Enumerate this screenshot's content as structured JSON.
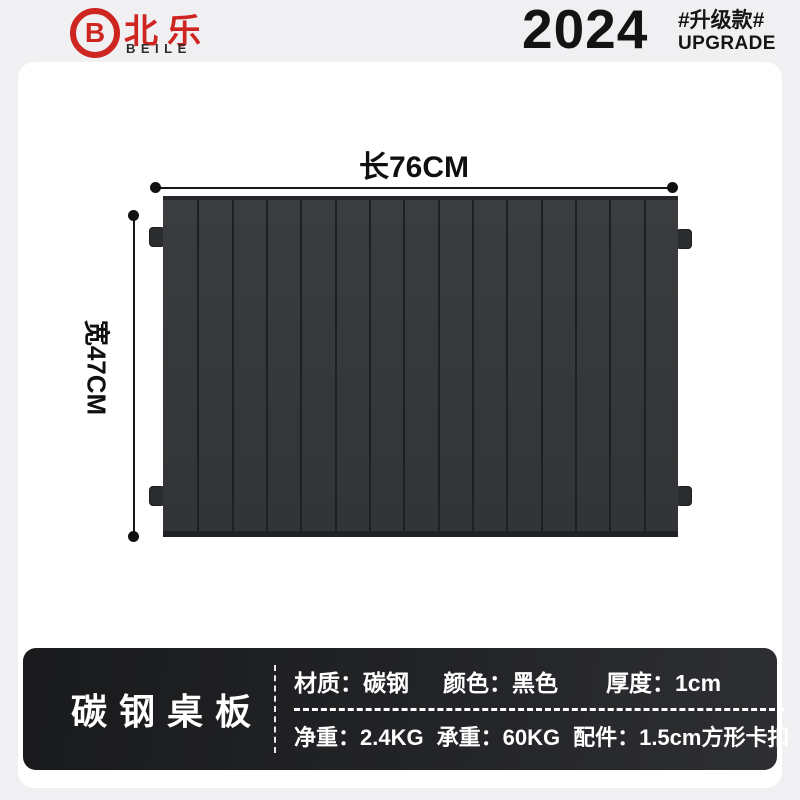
{
  "brand": {
    "logo_letter": "B",
    "name_cn": "北乐",
    "name_en": "BEILE"
  },
  "header": {
    "year": "2024",
    "badge_cn": "#升级款#",
    "badge_en": "UPGRADE"
  },
  "diagram": {
    "length_label": "长76CM",
    "width_label": "宽47CM",
    "slat_count": 15
  },
  "info_bar": {
    "title": "碳钢桌板",
    "row1": [
      "材质：碳钢",
      "颜色：黑色",
      "厚度：1cm"
    ],
    "row2": [
      "净重：2.4KG",
      "承重：60KG",
      "配件：1.5cm方形卡扣"
    ]
  },
  "colors": {
    "brand_red": "#cf2521",
    "board_gray": "#35373a",
    "bar_background": "#1d1e20",
    "page_background": "#f0f0f2",
    "card_background": "#ffffff",
    "text_dark": "#131313",
    "text_light": "#ffffff"
  }
}
